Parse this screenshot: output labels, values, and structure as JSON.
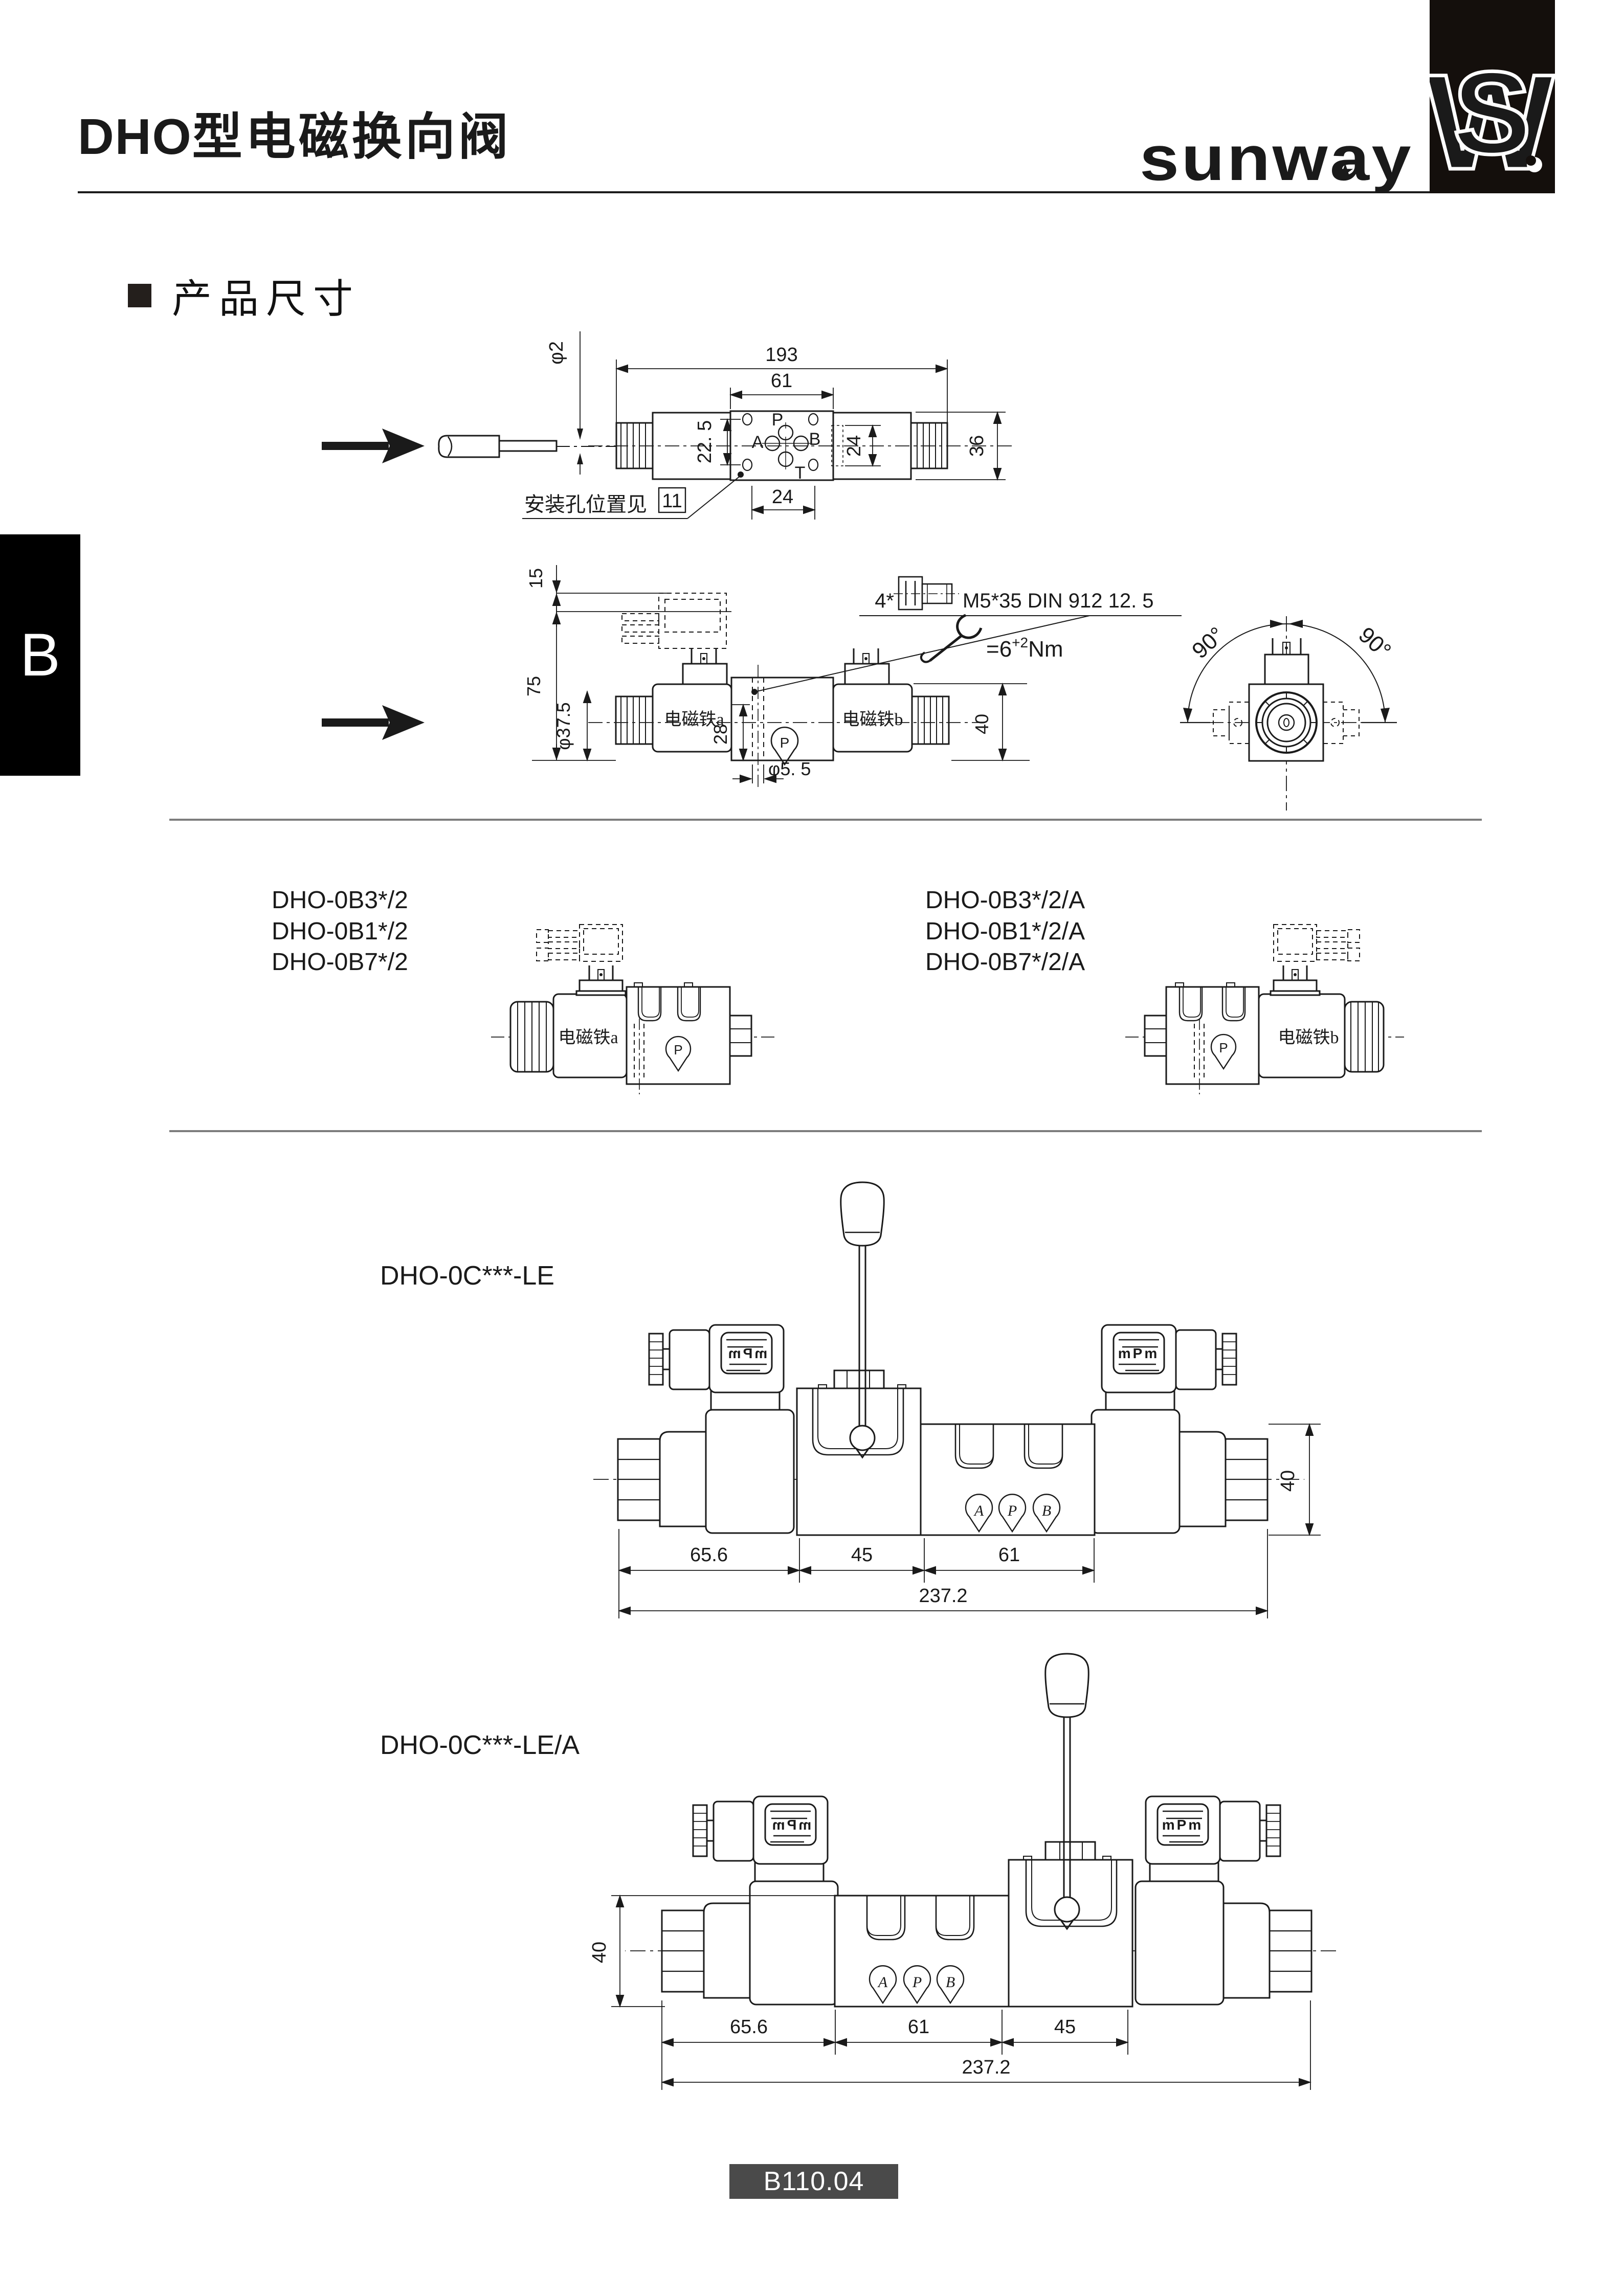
{
  "header": {
    "title_model": "DHO",
    "title_cn": "型电磁换向阀",
    "logotype": "sunway",
    "monogram_w": "W",
    "monogram_s": "S"
  },
  "section": {
    "title": "产品尺寸",
    "side_tab": "B"
  },
  "top_view": {
    "dim_overall": "193",
    "dim_body": "61",
    "dim_holes_v": "22. 5",
    "dim_right": "24",
    "dim_bottom": "24",
    "dim_height": "36",
    "dim_cable": "φ2",
    "port_p": "P",
    "port_a": "A",
    "port_b": "B",
    "port_t": "T",
    "note_text": "安装孔位置见",
    "note_ref": "11"
  },
  "front_view": {
    "dim_top": "15",
    "dim_total": "75",
    "dim_coil": "φ37.5",
    "dim_offset": "28",
    "dim_hole": "φ5. 5",
    "dim_height": "40",
    "solenoid_a": "电磁铁a",
    "solenoid_b": "电磁铁b",
    "port_p": "P",
    "bolt_qty": "4*",
    "bolt_spec": "M5*35  DIN 912 12. 5",
    "torque_prefix": "=6",
    "torque_sup": "+2",
    "torque_unit": "Nm",
    "rotate_left": "90°",
    "rotate_right": "90°"
  },
  "models_b": {
    "left": [
      "DHO-0B3*/2",
      "DHO-0B1*/2",
      "DHO-0B7*/2"
    ],
    "right": [
      "DHO-0B3*/2/A",
      "DHO-0B1*/2/A",
      "DHO-0B7*/2/A"
    ],
    "solenoid_a": "电磁铁a",
    "solenoid_b": "电磁铁b",
    "port_p": "P"
  },
  "le": {
    "model": "DHO-0C***-LE",
    "dim_1": "65.6",
    "dim_2": "45",
    "dim_3": "61",
    "dim_total": "237.2",
    "dim_height": "40",
    "port_a": "A",
    "port_p": "P",
    "port_b": "B",
    "connector": "mPm"
  },
  "lea": {
    "model": "DHO-0C***-LE/A",
    "dim_1": "65.6",
    "dim_2": "61",
    "dim_3": "45",
    "dim_total": "237.2",
    "dim_height": "40",
    "port_a": "A",
    "port_p": "P",
    "port_b": "B",
    "connector": "mPm"
  },
  "footer": {
    "code": "B110.04"
  }
}
